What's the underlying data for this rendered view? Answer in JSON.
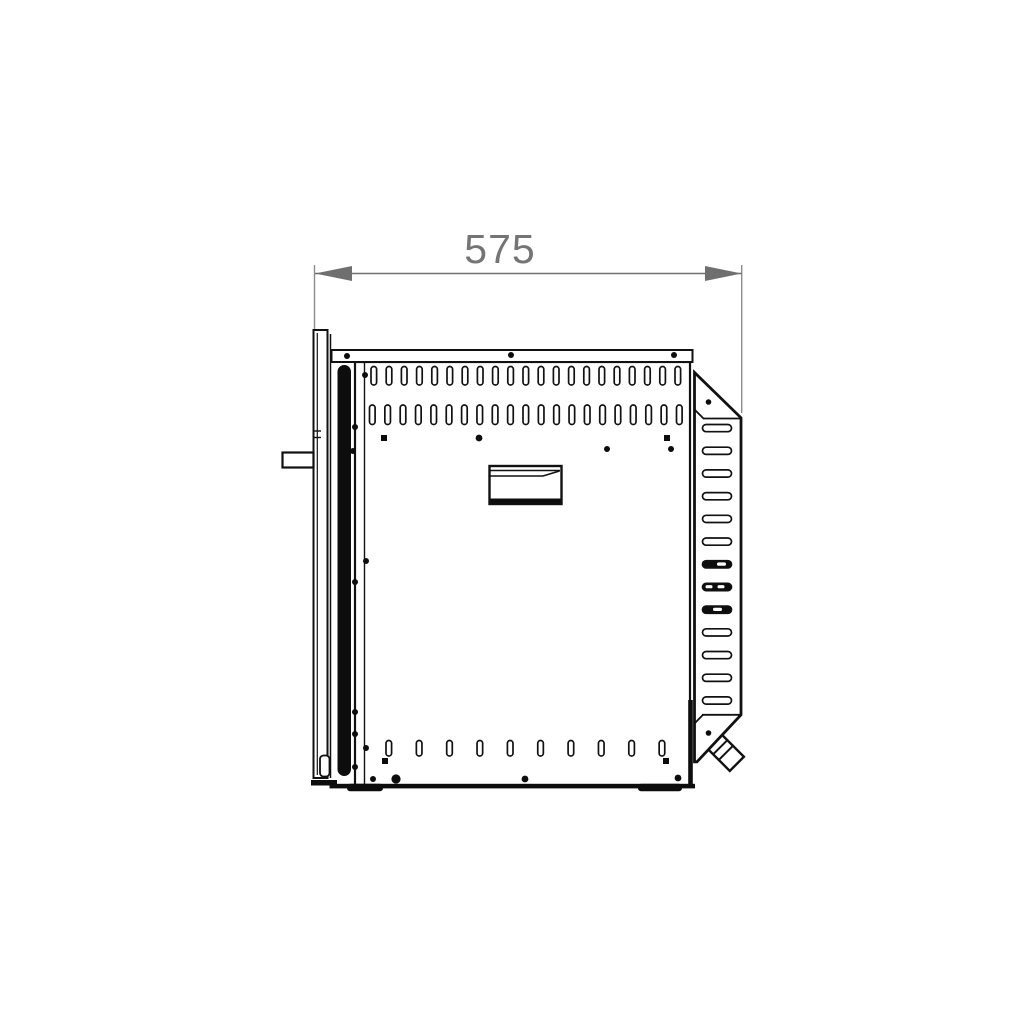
{
  "drawing": {
    "type": "technical-side-view",
    "subject": "built-in-oven-side-elevation"
  },
  "dimension": {
    "label": "575"
  },
  "vents": {
    "top_row_count": 21,
    "second_row_count": 21,
    "bottom_row_count": 10,
    "bracket_slot_count": 13,
    "bracket_dark_slots": [
      7,
      8,
      9
    ]
  },
  "colors": {
    "line": "#111111",
    "fill": "#ffffff",
    "dimension_gray": "#6f6f6f",
    "extension_gray": "#8c8c8c",
    "label_gray": "#757575",
    "solid_black": "#0d0d0d",
    "background": "#ffffff"
  }
}
